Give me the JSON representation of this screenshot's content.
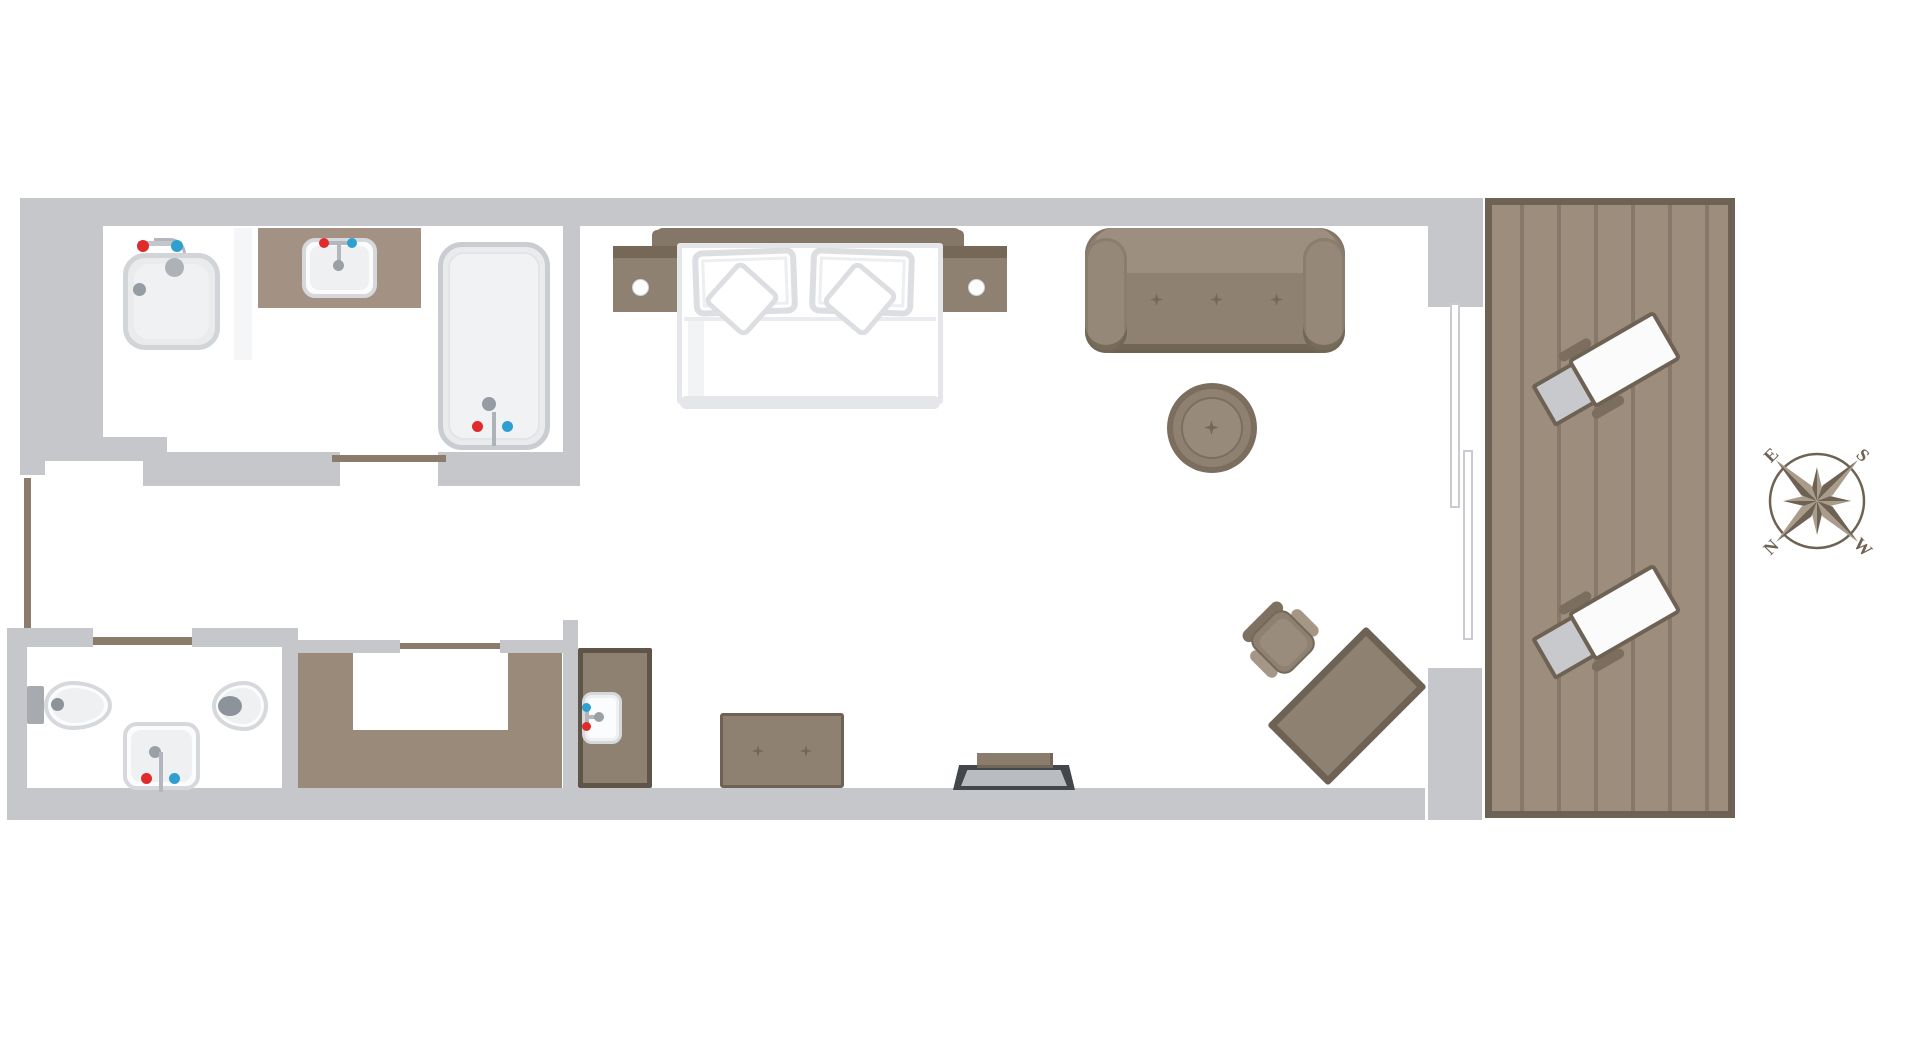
{
  "title": "hotel-room-floor-plan",
  "compass": {
    "top_left": "E",
    "top_right": "S",
    "bottom_left": "N",
    "bottom_right": "W"
  },
  "colors": {
    "background": "#ffffff",
    "wall": "#c5c7ca",
    "door_brown": "#8a7b6b",
    "wood_deck": "#9c8d7d",
    "wood_plank_line": "#87786a",
    "wood_border": "#6e6254",
    "furniture": "#8f8172",
    "furniture_light": "#9d8f7f",
    "furniture_dark": "#6e6254",
    "headboard": "#857767",
    "counter": "#a39183",
    "closet": "#998a7a",
    "fixture_fill": "#fbfcfd",
    "fixture_border": "#d6d8db",
    "fixture_inner": "#eff0f2",
    "metal_gray": "#9aa0a6",
    "hot_red": "#e02b2b",
    "cold_blue": "#2f9fd0",
    "rack_dark": "#43464a",
    "rack_light": "#b9bcc0",
    "lounger_pad": "#c7c9cd",
    "bed_border": "#e4e6e9",
    "pillow_border": "#dcdee1"
  },
  "symbols": [
    "shower-tray",
    "vanity-counter",
    "vanity-sink",
    "bathtub",
    "sliding-door-bathroom",
    "entry-door",
    "double-bed",
    "headboard",
    "nightstand-left",
    "nightstand-right",
    "sofa",
    "pouf",
    "desk",
    "desk-chair",
    "sliding-glass-door",
    "terrace-deck",
    "lounge-chair-1",
    "lounge-chair-2",
    "compass-rose",
    "wardrobe",
    "wardrobe-sliding-door",
    "minibar-cabinet",
    "minibar-sink",
    "bench-ottoman",
    "luggage-rack",
    "bidet",
    "toilet",
    "wc-sink",
    "wc-door"
  ]
}
